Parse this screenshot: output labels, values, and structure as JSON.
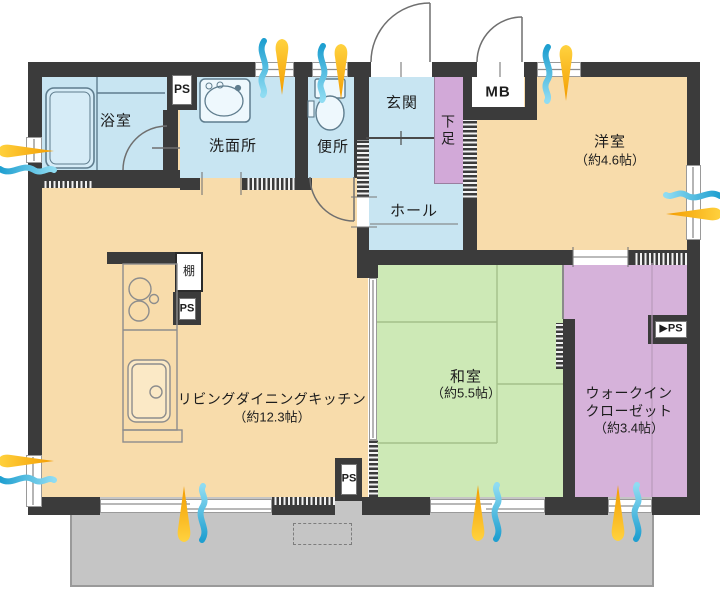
{
  "floorplan": {
    "rooms": {
      "bathroom": {
        "label": "浴室"
      },
      "washroom": {
        "label": "洗面所"
      },
      "toilet": {
        "label": "便所"
      },
      "entrance": {
        "label": "玄関"
      },
      "shoe_box": {
        "label": "下足"
      },
      "hall": {
        "label": "ホール"
      },
      "western_room": {
        "label": "洋室",
        "area": "（約4.6帖）"
      },
      "ldk": {
        "label": "リビングダイニングキッチン",
        "area": "（約12.3帖）"
      },
      "japanese_room": {
        "label": "和室",
        "area": "（約5.5帖）"
      },
      "walk_in_closet": {
        "label_line1": "ウォークイン",
        "label_line2": "クローゼット",
        "area": "（約3.4帖）"
      },
      "shelf": {
        "label": "棚"
      }
    },
    "boxes": {
      "ps": "PS",
      "ps_right": "▶PS",
      "mb": "MB"
    },
    "icons": {
      "airflow": "airflow-ventilation-icon"
    },
    "colors": {
      "wall": "#3b3b3b",
      "water_rooms_blue": "#c8e5f2",
      "living_peach": "#f8dcab",
      "tatami_green": "#cde9b6",
      "closet_purple": "#d6b2da",
      "balcony_gray": "#c5c5c5",
      "airflow_blue": "#35aedb",
      "airflow_yellow": "#f7a600"
    }
  }
}
